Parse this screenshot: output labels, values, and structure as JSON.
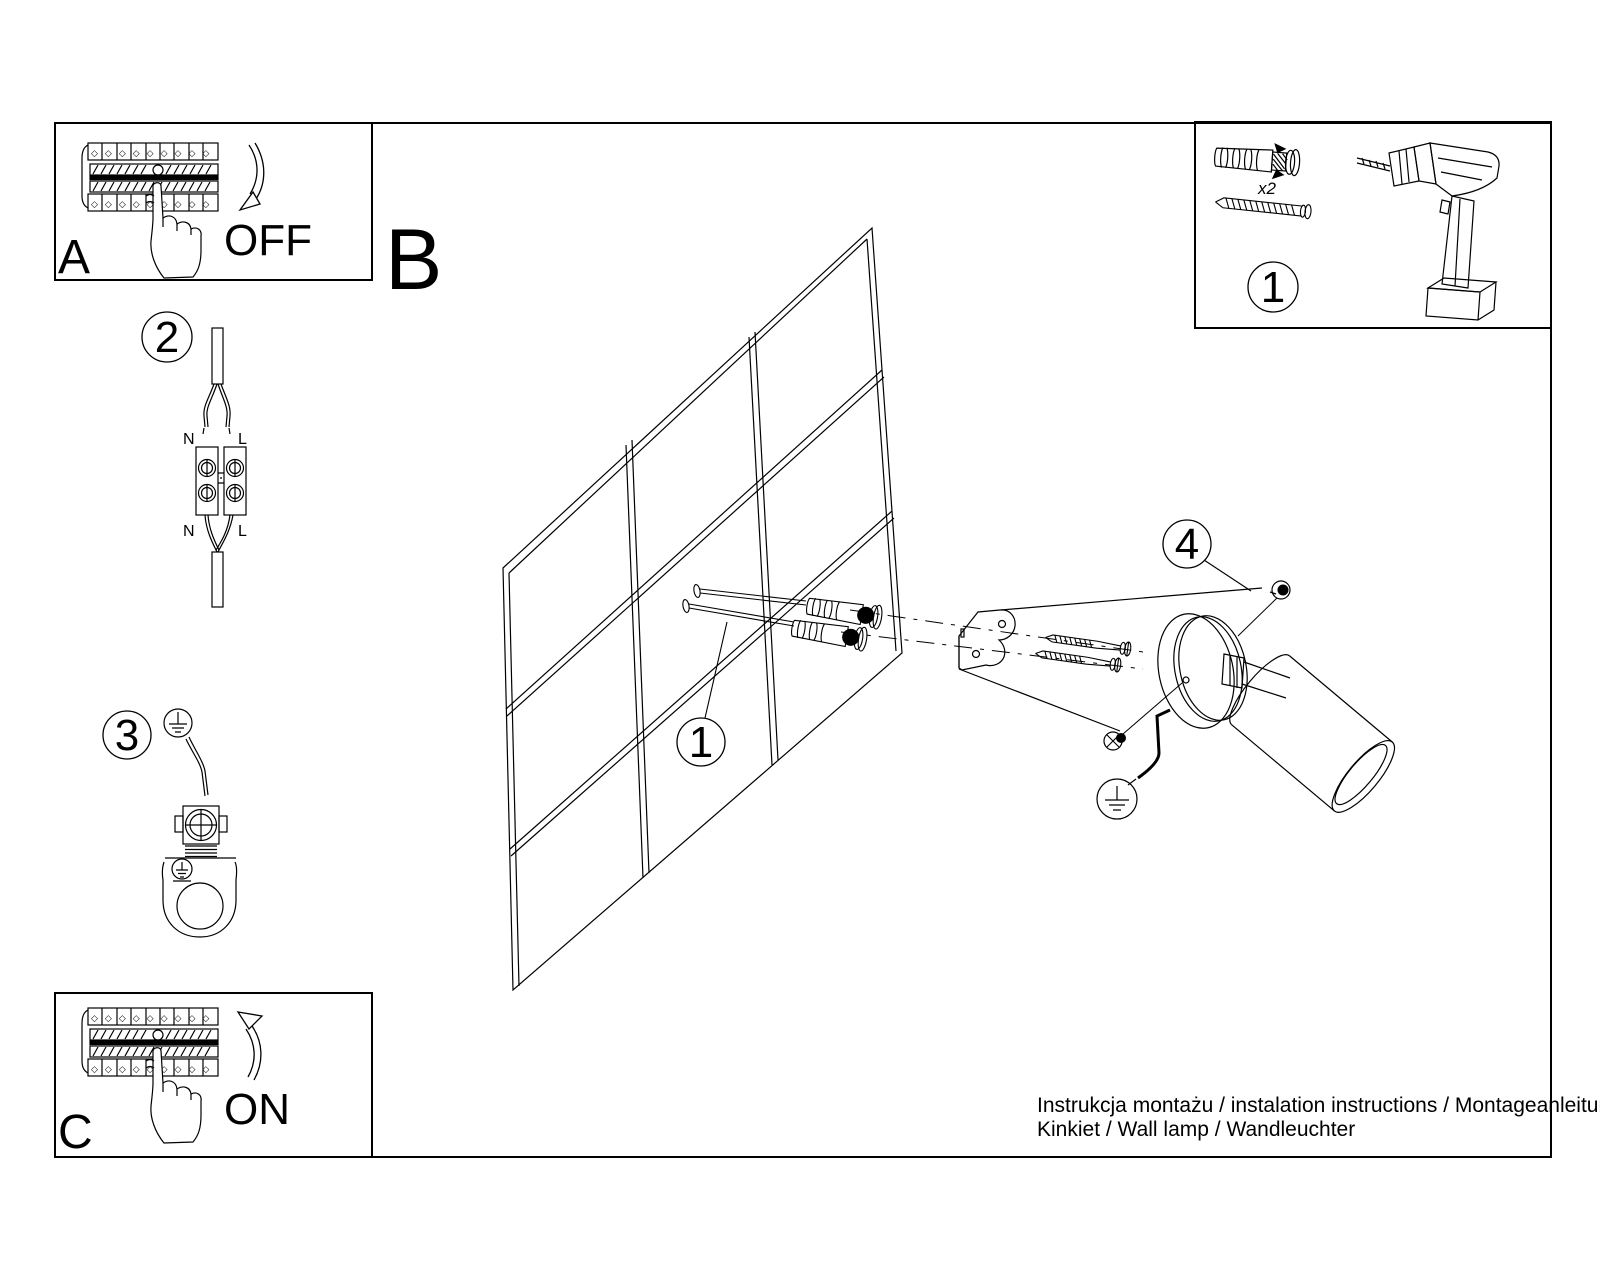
{
  "panel_a": {
    "label": "A",
    "state": "OFF"
  },
  "panel_c": {
    "label": "C",
    "state": "ON"
  },
  "section_label": "B",
  "callouts": {
    "tools": "1",
    "wall": "1",
    "wiring": "2",
    "ground": "3",
    "fix": "4"
  },
  "wiring_labels": {
    "n_top": "N",
    "l_top": "L",
    "n_bottom": "N",
    "l_bottom": "L"
  },
  "tools": {
    "anchor_qty": "x2"
  },
  "decor": {
    "breaker_diamonds": "◇◇◇◇◇◇◇◇◇"
  },
  "footer": {
    "line1": "Instrukcja montażu / instalation instructions / Montageanleitung",
    "line2": "Kinkiet / Wall lamp / Wandleuchter"
  },
  "colors": {
    "ink": "#000000",
    "paper": "#ffffff"
  }
}
